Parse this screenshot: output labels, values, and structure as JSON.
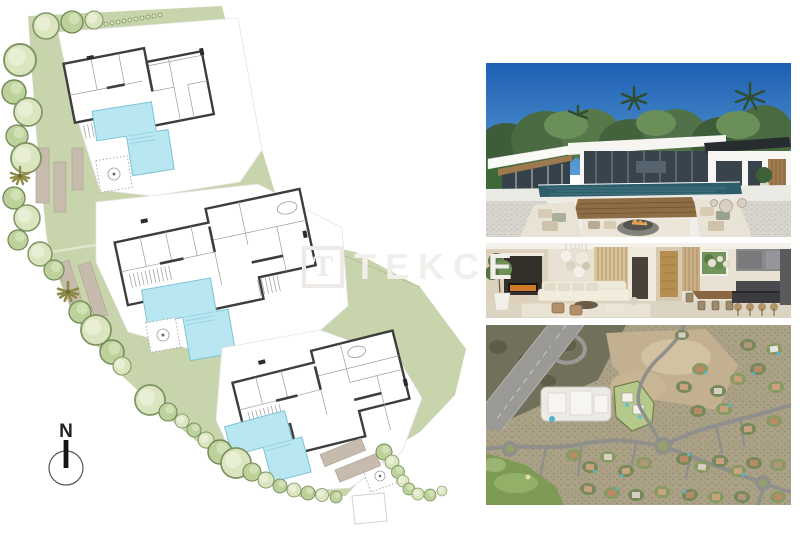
{
  "page": {
    "background_color": "#ffffff",
    "kind": "real-estate media collage: site plan with three villa floor plans, exterior render, interior render, aerial photo"
  },
  "watermark": {
    "logo_letter": "T",
    "text": "TEKCE",
    "color": "#f1efec"
  },
  "site_plan": {
    "compass_label": "N",
    "villa_count": 3,
    "colors": {
      "plot_green": "#c8d4ab",
      "pool_blue": "#b9e7f1",
      "wall_dark": "#3d3d3d",
      "tree_green": "#bcd29a",
      "deck_tan": "#c7bbad"
    }
  },
  "photos": {
    "exterior": {
      "name": "villa-exterior-render",
      "sky_color": "#2a66b4"
    },
    "interior": {
      "name": "interior-render"
    },
    "aerial": {
      "name": "aerial-neighborhood-view"
    }
  }
}
